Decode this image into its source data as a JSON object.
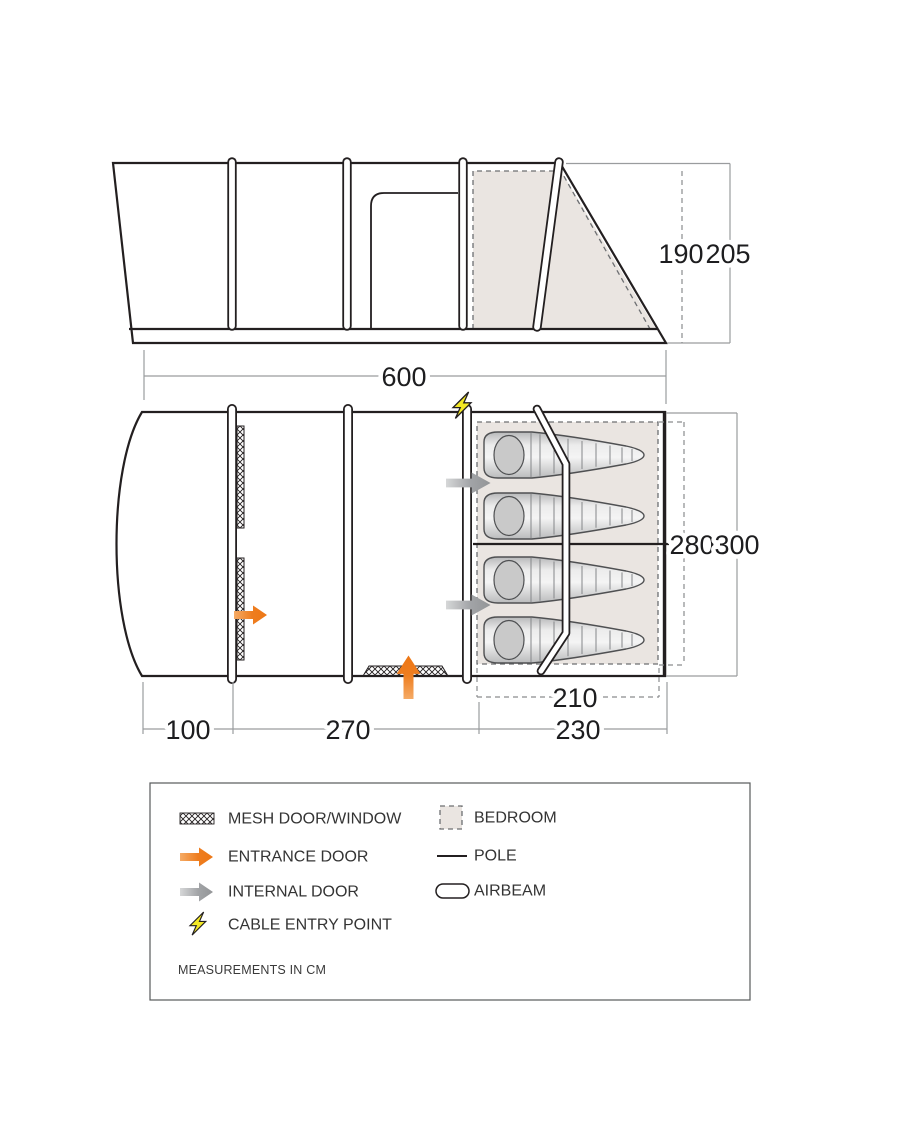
{
  "diagram": {
    "dims": {
      "inner_height": "190",
      "outer_height": "205",
      "length": "600",
      "front_depth": "100",
      "living_length": "270",
      "bedroom_length": "230",
      "bedroom_width": "210",
      "inner_width": "280",
      "outer_width": "300"
    },
    "legend": {
      "left": [
        {
          "icon": "mesh",
          "label": "MESH DOOR/WINDOW"
        },
        {
          "icon": "entrance-arrow",
          "label": "ENTRANCE DOOR"
        },
        {
          "icon": "internal-arrow",
          "label": "INTERNAL DOOR"
        },
        {
          "icon": "lightning",
          "label": "CABLE ENTRY POINT"
        }
      ],
      "right": [
        {
          "icon": "bedroom-swatch",
          "label": "BEDROOM"
        },
        {
          "icon": "pole-line",
          "label": "POLE"
        },
        {
          "icon": "airbeam-capsule",
          "label": "AIRBEAM"
        }
      ],
      "note": "MEASUREMENTS IN CM"
    },
    "colors": {
      "outline": "#231f20",
      "entrance_orange": "#ee7d1f",
      "internal_gray": "#97999c",
      "cable_yellow": "#f3e825",
      "bedroom_fill": "#eae5e1",
      "dim_gray": "#9a9c9e"
    }
  }
}
